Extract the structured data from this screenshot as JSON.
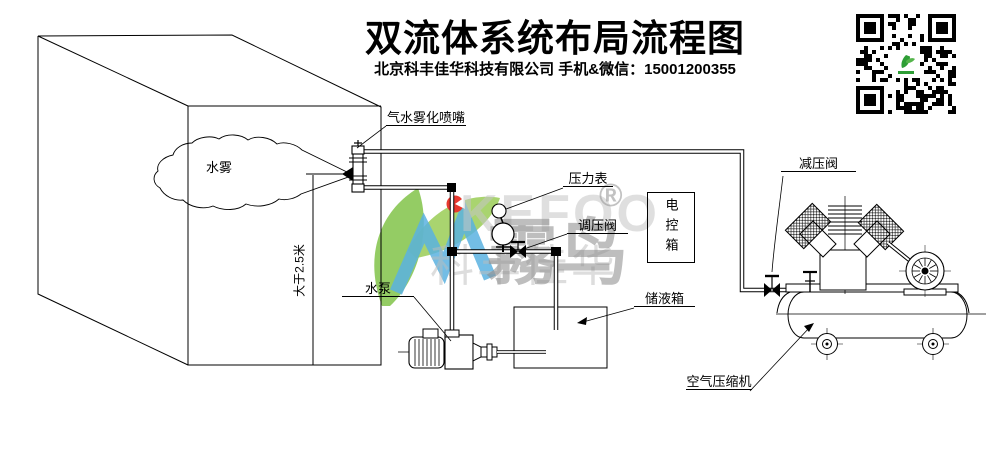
{
  "header": {
    "title": "双流体系统布局流程图",
    "subtitle": "北京科丰佳华科技有限公司 手机&微信：15001200355"
  },
  "diagram": {
    "labels": {
      "nozzle": "气水雾化喷嘴",
      "mist": "水雾",
      "min_height": "大于2.5米",
      "pressure_gauge": "压力表",
      "regulating_valve": "调压阀",
      "control_box": "电控箱",
      "water_pump": "水泵",
      "storage_tank": "储液箱",
      "reducing_valve": "减压阀",
      "air_compressor": "空气压缩机"
    }
  },
  "watermark": {
    "brand_latin": "KEFOO",
    "brand_cn": "霧鸟",
    "brand_sub": "科丰佳华",
    "registered": "®"
  },
  "colors": {
    "line": "#000000",
    "leaf_green": "#7cc142",
    "logo_blue": "#58b0e3",
    "logo_red": "#e8392f",
    "watermark_gray": "#8a8a8a"
  }
}
